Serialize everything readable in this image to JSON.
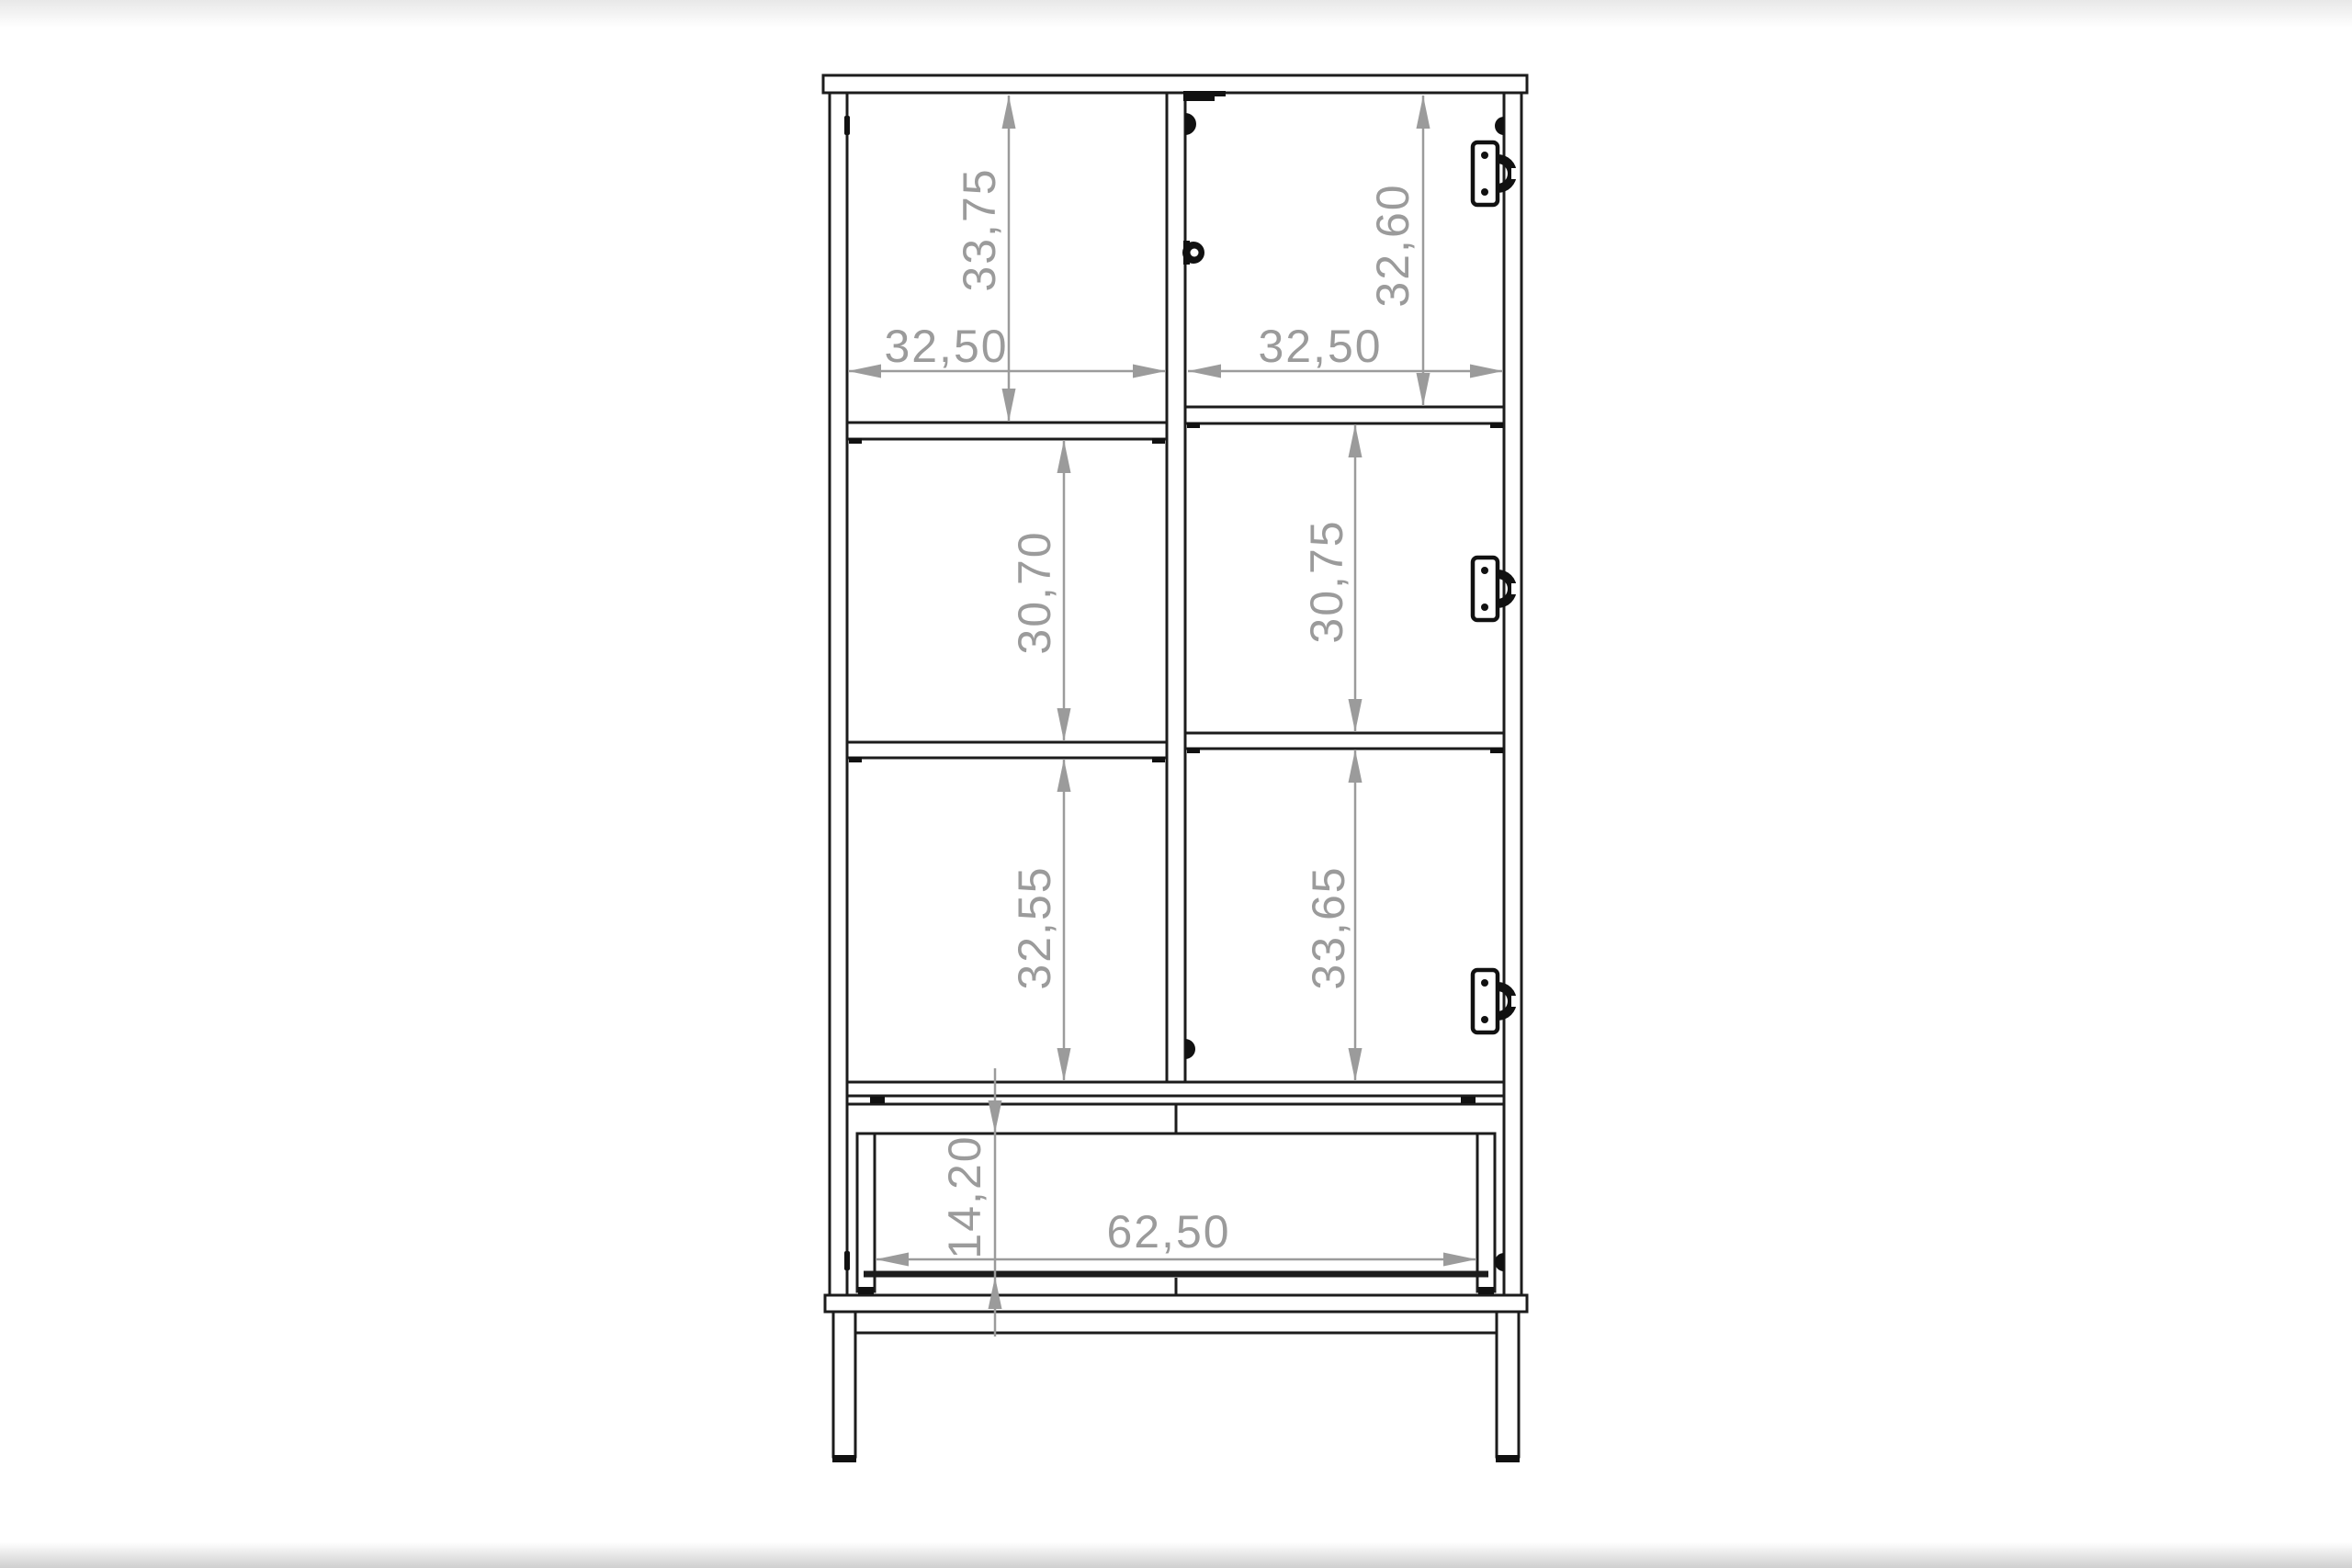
{
  "page": {
    "background_color": "#ffffff",
    "content": "furniture technical drawing - display cabinet front elevation with interior dimensions"
  },
  "drawing": {
    "line_color": "#1c1c1c",
    "dimension_color": "#9b9b9b",
    "dimensions": {
      "top_left_compartment_height": "33,75",
      "top_right_compartment_height": "32,60",
      "left_compartment_width": "32,50",
      "right_compartment_width": "32,50",
      "middle_left_compartment_height": "30,70",
      "middle_right_compartment_height": "30,75",
      "lower_left_compartment_height": "32,55",
      "lower_right_compartment_height": "33,65",
      "drawer_opening_height": "14,20",
      "drawer_opening_width": "62,50"
    },
    "icons": {
      "hinge_icon": "concealed-cup-hinge",
      "hinge_count": 3
    }
  }
}
